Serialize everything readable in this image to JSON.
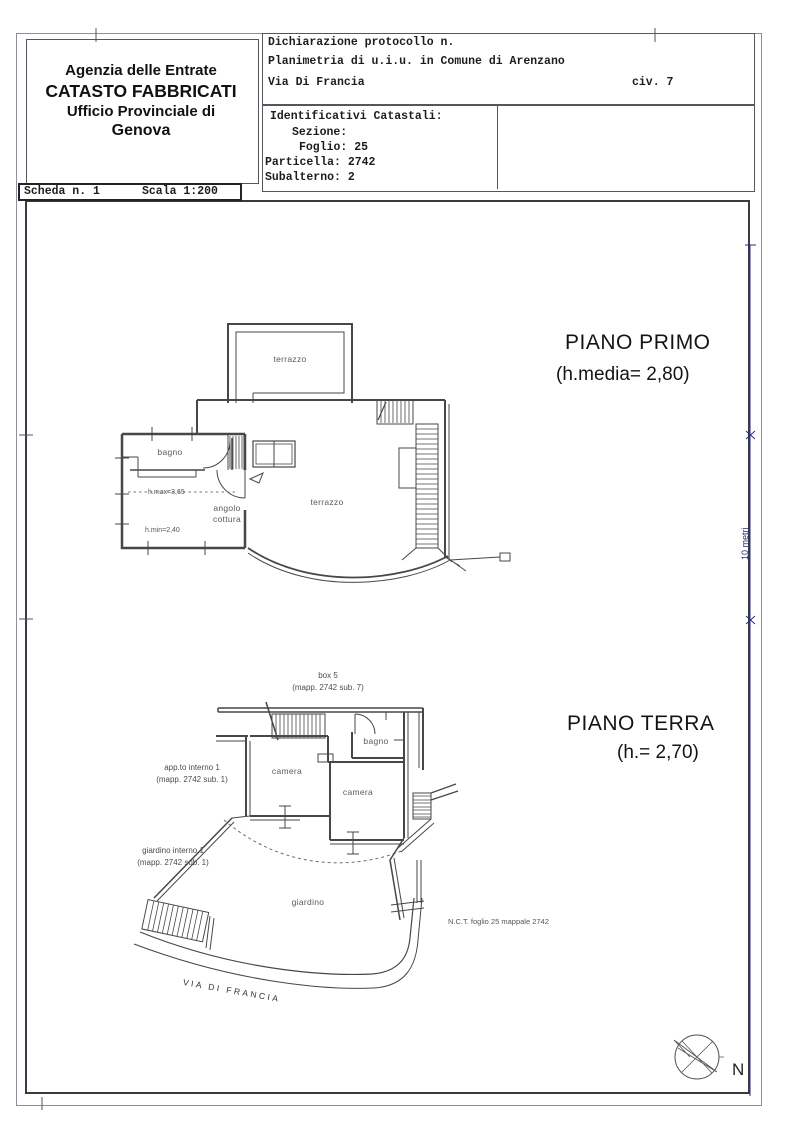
{
  "agency": {
    "line1": "Agenzia delle Entrate",
    "line2": "CATASTO FABBRICATI",
    "line3": "Ufficio Provinciale di",
    "line4": "Genova"
  },
  "scheda": {
    "number": "Scheda n. 1",
    "scale": "Scala 1:200"
  },
  "declaration": {
    "protocol": "Dichiarazione protocollo n.",
    "planimetria": "Planimetria di u.i.u. in Comune di Arenzano",
    "street": "Via Di Francia",
    "civic": "civ. 7"
  },
  "catasto": {
    "title": "Identificativi Catastali:",
    "sezione": "Sezione:",
    "foglio": "Foglio: 25",
    "particella": "Particella: 2742",
    "subalterno": "Subalterno: 2"
  },
  "piano_primo": {
    "title": "PIANO PRIMO",
    "height": "(h.media= 2,80)",
    "terrazzo_top": "terrazzo",
    "bagno": "bagno",
    "angolo_cottura": "angolo cottura",
    "terrazzo_main": "terrazzo",
    "h_max": "h.max=3,65",
    "h_min": "h.min=2,40"
  },
  "piano_terra": {
    "title": "PIANO TERRA",
    "height": "(h.= 2,70)",
    "box": "box 5",
    "box_mapp": "(mapp. 2742 sub. 7)",
    "appto": "app.to interno 1",
    "appto_mapp": "(mapp. 2742 sub. 1)",
    "camera1": "camera",
    "camera2": "camera",
    "bagno": "bagno",
    "giardino_interno": "giardino interno 1",
    "giardino_interno_mapp": "(mapp. 2742 sub. 1)",
    "giardino": "giardino",
    "nct": "N.C.T. foglio 25 mappale 2742",
    "via": "VIA DI FRANCIA"
  },
  "scalebar": {
    "label": "10 metri",
    "color": "#2b2b8a"
  },
  "compass": {
    "north": "N"
  }
}
